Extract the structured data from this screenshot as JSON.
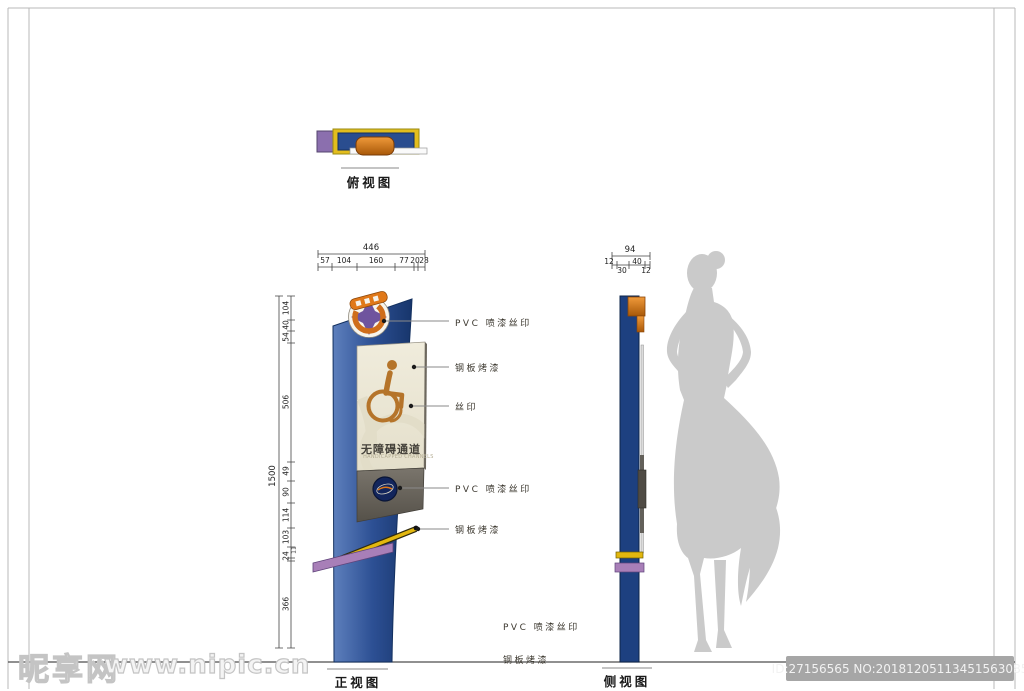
{
  "page": {
    "watermark": {
      "site": "昵享网",
      "url": "www.nipic.cn"
    },
    "id_badge": "ID:27156565 NO:20181205113451563085"
  },
  "views": {
    "top_view": {
      "label": "俯视图"
    },
    "front_view": {
      "label": "正视图"
    },
    "side_view": {
      "label": "侧视图"
    }
  },
  "sign_panel": {
    "title": "无障碍通道",
    "subtitle": "HANDICAPPED CHANNELS"
  },
  "annotations": {
    "logo_material": "PVC 喷漆丝印",
    "panel_material": "钢板烤漆",
    "print": "丝印",
    "badge_material": "PVC 喷漆丝印",
    "strip_material": "钢板烤漆",
    "bottom_pvc": "PVC 喷漆丝印",
    "bottom_steel": "钢板烤漆"
  },
  "dimensions": {
    "front_width": {
      "total": "446",
      "segments": [
        "57",
        "104",
        "160",
        "77",
        "20",
        "28"
      ]
    },
    "front_height": {
      "total": "1500",
      "segments": [
        "104",
        "40",
        "54",
        "506",
        "49",
        "90",
        "114",
        "103",
        "24",
        "11",
        "366"
      ]
    },
    "side_width": {
      "total": "94",
      "segments": [
        "12",
        "30",
        "40",
        "12"
      ]
    }
  },
  "colors": {
    "blade_blue": "#2d5094",
    "panel_cream": "#ece8d6",
    "symbol_orange": "#b5742a",
    "band_gray": "#6b665e",
    "accent_yellow": "#e2b70e",
    "accent_purple": "#a87fb8",
    "logo_orange": "#e07818",
    "logo_purple": "#6f549e",
    "silhouette_gray": "#cacaca"
  }
}
